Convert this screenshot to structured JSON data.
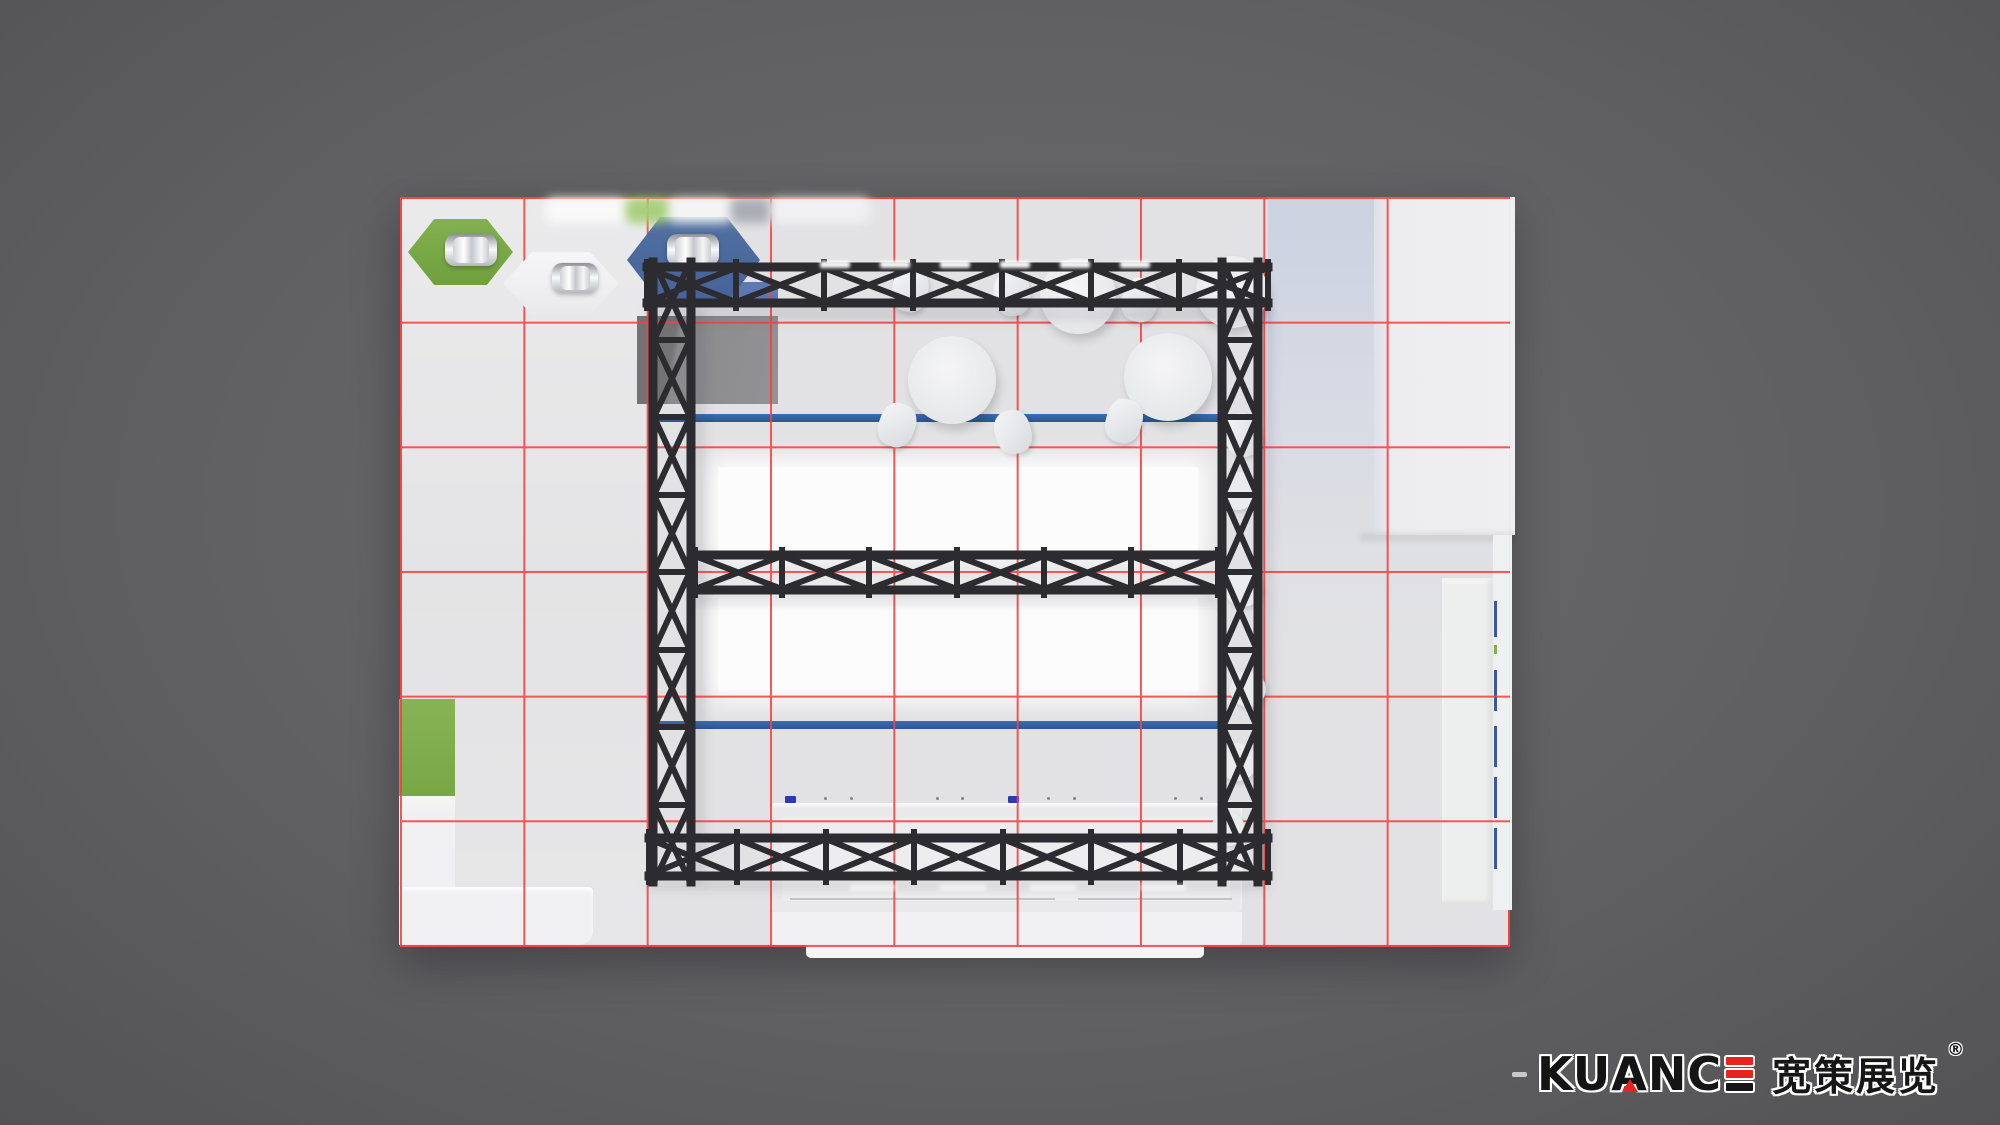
{
  "scene": {
    "type": "3d-top-view-render",
    "subject": "exhibition booth floor plan with measurement grid",
    "background_color": "#606062",
    "floor_color": "#e2e2e4",
    "grid": {
      "color": "#f84040",
      "columns": 9,
      "rows": 6
    }
  },
  "palette": {
    "truss_black": "#2c2b2f",
    "banner_blue": "#2f5fa7",
    "booth_blue": "#4d6ca6",
    "booth_green": "#7cab4b",
    "glow_white": "#fcfcfd",
    "counter_white": "#efeff1",
    "logo_red": "#e8231f"
  },
  "objects": {
    "hexagon_tables": [
      "green",
      "white",
      "blue"
    ],
    "chrome_chairs": 3,
    "round_tables": 2,
    "cafe_chairs": 7,
    "stools": 5,
    "glow_panels": 2,
    "blue_banners": 2,
    "truss_parts": [
      "top",
      "middle",
      "bottom",
      "left-column",
      "right-column"
    ],
    "counters": [
      "left-l-counter",
      "bottom-reception-counter",
      "right-tall-counter"
    ],
    "walls": [
      "top-right-panel",
      "left-green-wall",
      "right-strip"
    ]
  },
  "logo": {
    "dash": "-",
    "part1": "KU",
    "a": "A",
    "part2": "NC",
    "cn": "宽策展览",
    "reg": "®"
  }
}
